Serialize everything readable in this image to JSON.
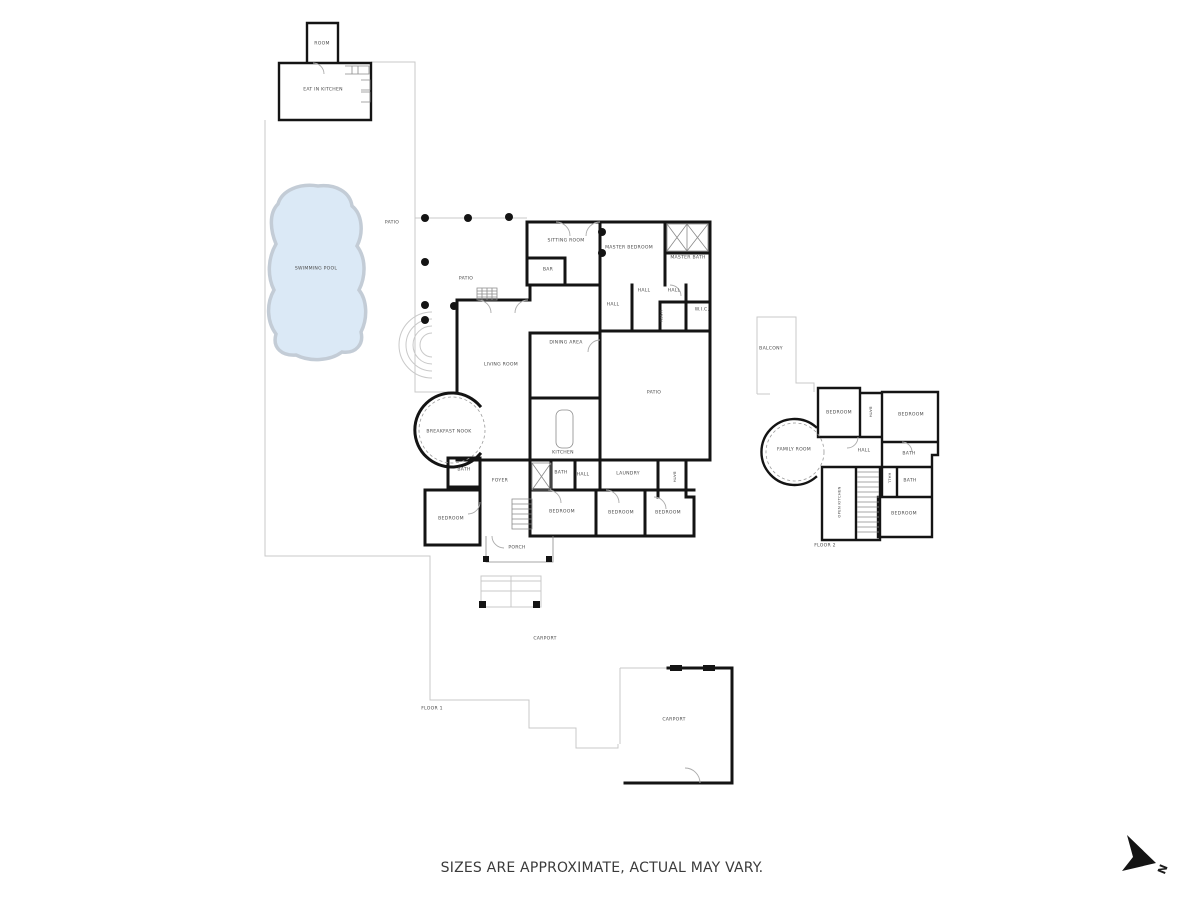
{
  "meta": {
    "disclaimer": "SIZES ARE APPROXIMATE, ACTUAL MAY VARY.",
    "north": "N"
  },
  "colors": {
    "wall": "#141414",
    "thin": "#c9c9c9",
    "door": "#ababab",
    "pool-fill": "#dbe9f6",
    "pool-edge": "#c3ccd6",
    "label": "#4b4b4b"
  },
  "floors": {
    "floor1": "FLOOR 1",
    "floor2": "FLOOR 2"
  },
  "labels": [
    {
      "name": "label-poolhouse-room",
      "text": "ROOM",
      "x": 322,
      "y": 44
    },
    {
      "name": "label-poolhouse-eat-in-kitchen",
      "text": "EAT IN KITCHEN",
      "x": 323,
      "y": 90
    },
    {
      "name": "label-swimming-pool",
      "text": "SWIMMING POOL",
      "x": 316,
      "y": 269
    },
    {
      "name": "label-patio-upper",
      "text": "PATIO",
      "x": 392,
      "y": 223
    },
    {
      "name": "label-patio-west",
      "text": "PATIO",
      "x": 466,
      "y": 279
    },
    {
      "name": "label-sitting-room",
      "text": "SITTING ROOM",
      "x": 566,
      "y": 241
    },
    {
      "name": "label-master-bedroom",
      "text": "MASTER BEDROOM",
      "x": 629,
      "y": 248
    },
    {
      "name": "label-master-bath",
      "text": "MASTER BATH",
      "x": 688,
      "y": 258
    },
    {
      "name": "label-bar",
      "text": "BAR",
      "x": 548,
      "y": 270
    },
    {
      "name": "label-hall-1",
      "text": "HALL",
      "x": 644,
      "y": 291
    },
    {
      "name": "label-hall-2",
      "text": "HALL",
      "x": 674,
      "y": 291
    },
    {
      "name": "label-hall-3",
      "text": "HALL",
      "x": 613,
      "y": 305
    },
    {
      "name": "label-wic",
      "text": "W.I.C.",
      "x": 702,
      "y": 310
    },
    {
      "name": "label-linen-closet",
      "text": "LINEN",
      "x": 661,
      "y": 316,
      "rot": 90,
      "fs": 3.6
    },
    {
      "name": "label-dining-area",
      "text": "DINING AREA",
      "x": 566,
      "y": 343
    },
    {
      "name": "label-living-room",
      "text": "LIVING ROOM",
      "x": 501,
      "y": 365
    },
    {
      "name": "label-patio-court",
      "text": "PATIO",
      "x": 654,
      "y": 393
    },
    {
      "name": "label-breakfast-nook",
      "text": "BREAKFAST NOOK",
      "x": 449,
      "y": 432
    },
    {
      "name": "label-kitchen",
      "text": "KITCHEN",
      "x": 563,
      "y": 453
    },
    {
      "name": "label-bath-nook",
      "text": "BATH",
      "x": 464,
      "y": 470
    },
    {
      "name": "label-foyer",
      "text": "FOYER",
      "x": 500,
      "y": 481
    },
    {
      "name": "label-bath-hall",
      "text": "BATH",
      "x": 561,
      "y": 473
    },
    {
      "name": "label-hall-4",
      "text": "HALL",
      "x": 583,
      "y": 475
    },
    {
      "name": "label-laundry",
      "text": "LAUNDRY",
      "x": 628,
      "y": 474
    },
    {
      "name": "label-bath-laundry",
      "text": "BATH",
      "x": 675,
      "y": 477,
      "rot": 90,
      "fs": 3.8
    },
    {
      "name": "label-bedroom-1",
      "text": "BEDROOM",
      "x": 562,
      "y": 512
    },
    {
      "name": "label-bedroom-2",
      "text": "BEDROOM",
      "x": 621,
      "y": 513
    },
    {
      "name": "label-bedroom-3",
      "text": "BEDROOM",
      "x": 668,
      "y": 513
    },
    {
      "name": "label-bedroom-west",
      "text": "BEDROOM",
      "x": 451,
      "y": 519
    },
    {
      "name": "label-porch",
      "text": "PORCH",
      "x": 517,
      "y": 548
    },
    {
      "name": "label-carport-1",
      "text": "CARPORT",
      "x": 545,
      "y": 639
    },
    {
      "name": "label-floor-1",
      "text": "FLOOR 1",
      "x": 432,
      "y": 709
    },
    {
      "name": "label-carport-2",
      "text": "CARPORT",
      "x": 674,
      "y": 720
    },
    {
      "name": "label-balcony",
      "text": "BALCONY",
      "x": 771,
      "y": 349
    },
    {
      "name": "label-f2-bedroom-1",
      "text": "BEDROOM",
      "x": 839,
      "y": 413
    },
    {
      "name": "label-f2-bath-1",
      "text": "BATH",
      "x": 871,
      "y": 412,
      "rot": 90,
      "fs": 3.8
    },
    {
      "name": "label-f2-bedroom-2",
      "text": "BEDROOM",
      "x": 911,
      "y": 415
    },
    {
      "name": "label-family-room",
      "text": "FAMILY ROOM",
      "x": 794,
      "y": 450
    },
    {
      "name": "label-f2-hall-1",
      "text": "HALL",
      "x": 864,
      "y": 451
    },
    {
      "name": "label-f2-bath-2",
      "text": "BATH",
      "x": 909,
      "y": 454
    },
    {
      "name": "label-f2-hall-2",
      "text": "HALL",
      "x": 890,
      "y": 478,
      "rot": 90,
      "fs": 3.8
    },
    {
      "name": "label-f2-bath-3",
      "text": "BATH",
      "x": 910,
      "y": 481
    },
    {
      "name": "label-open-kitchen",
      "text": "OPEN KITCHEN",
      "x": 839,
      "y": 502,
      "rot": -90,
      "fs": 3.8
    },
    {
      "name": "label-f2-bedroom-3",
      "text": "BEDROOM",
      "x": 904,
      "y": 514
    },
    {
      "name": "label-floor-2",
      "text": "FLOOR 2",
      "x": 825,
      "y": 546
    }
  ]
}
